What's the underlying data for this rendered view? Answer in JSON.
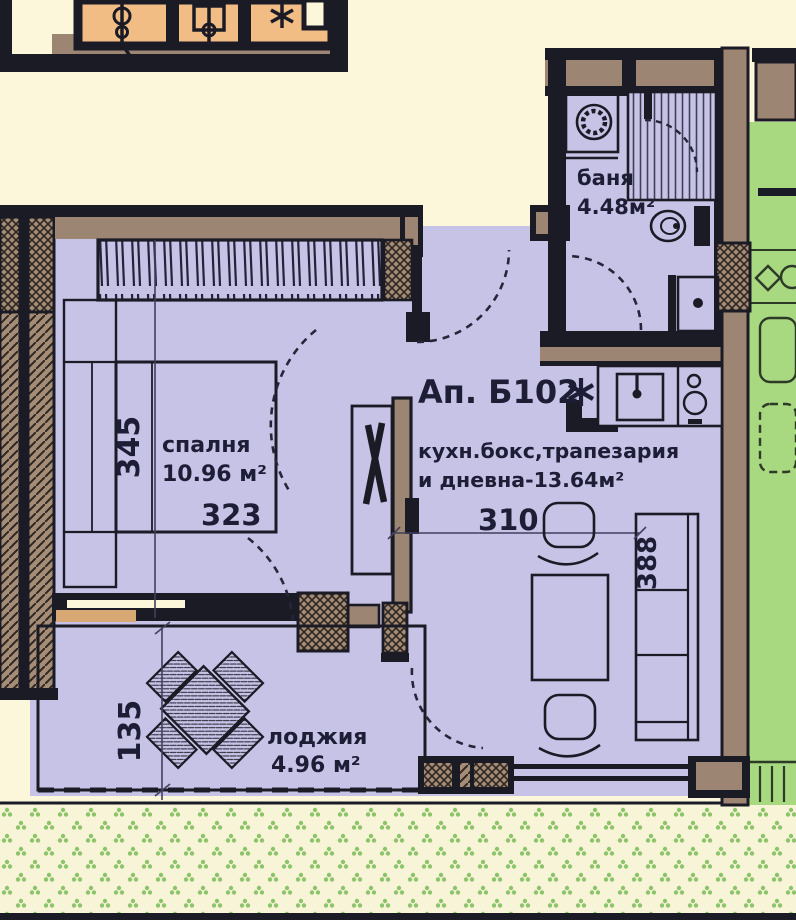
{
  "plan": {
    "apartment": {
      "label": "Ап. Б102"
    },
    "bedroom": {
      "name": "спалня",
      "area": "10.96 м²",
      "dim_w": "323",
      "dim_h": "345"
    },
    "living": {
      "line1": "кухн.бокс,трапезария",
      "line2": "и дневна-13.64м²",
      "dim_w": "310",
      "dim_h": "388"
    },
    "bathroom": {
      "name": "баня",
      "area": "4.48м²"
    },
    "loggia": {
      "name": "лоджия",
      "area": "4.96 м²",
      "dim_h": "135"
    },
    "icons": {
      "entrance_star": "eight-spoked-asterisk",
      "riser_symbols": "plumbing-riser-symbols"
    },
    "colors": {
      "floor": "#c7c3e6",
      "walls_fill": "#9d8573",
      "outline": "#1b1b26",
      "adjacent_left_unit": "#f2bd85",
      "adjacent_right_unit": "#a8d880",
      "background": "#fcf7da",
      "garden_dots": "#8cc46a",
      "text": "#1d1d36"
    }
  }
}
